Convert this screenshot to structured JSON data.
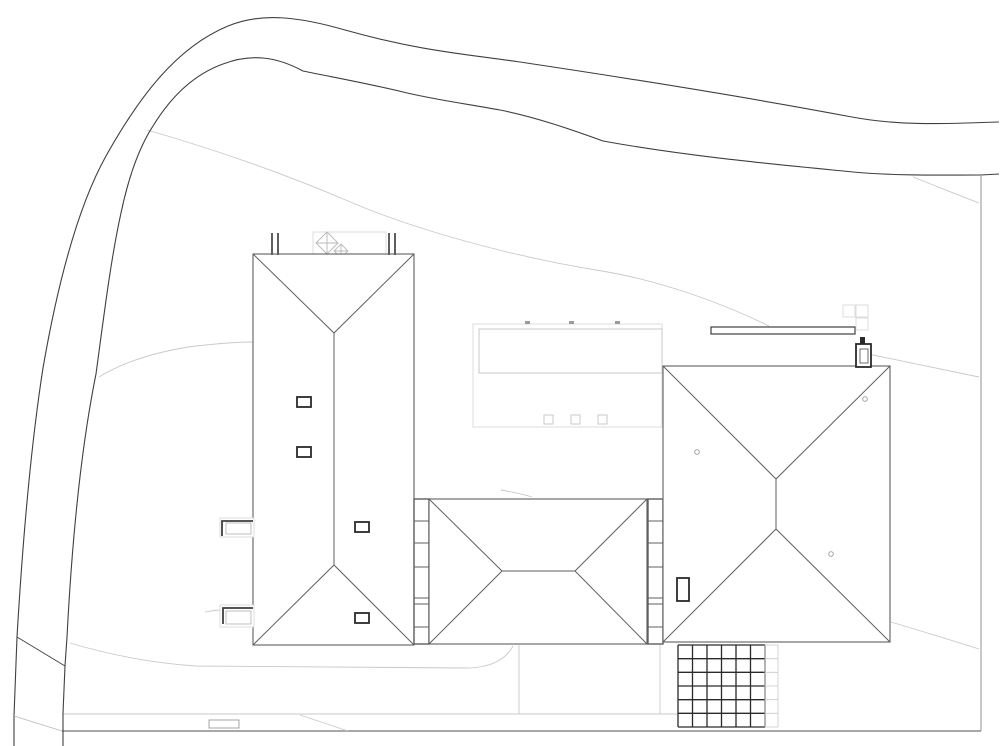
{
  "document": {
    "kind": "architectural-site-plan-roof-view",
    "visible_text": ""
  },
  "canvas": {
    "width": 1000,
    "height": 746,
    "background": "#ffffff"
  },
  "palette": {
    "road": "#3f3f3f",
    "roof": "#5f5f5f",
    "dark": "#2a2a2a",
    "mid": "#9b9b9b",
    "soft": "#b8b8b8",
    "light": "#c9c9c9",
    "faint": "#dcdcdc",
    "white": "#ffffff"
  },
  "layers": [
    {
      "name": "terrain-contours",
      "primitives": [
        {
          "type": "path",
          "name": "contour-upper",
          "d": "M 147,130 C 210,148 280,172 348,201 C 420,232 520,258 602,271 C 662,281 722,303 769,326",
          "stroke": "light",
          "sw": 0.9
        },
        {
          "type": "path",
          "name": "contour-left",
          "d": "M 99,377 C 125,361 158,352 188,347 C 212,344 235,342 253,342",
          "stroke": "light",
          "sw": 0.9
        },
        {
          "type": "path",
          "name": "contour-right-top",
          "d": "M 913,177 C 936,186 958,195 979,203",
          "stroke": "light",
          "sw": 0.9
        },
        {
          "type": "path",
          "name": "contour-right-mid",
          "d": "M 868,354 C 906,362 944,370 979,377",
          "stroke": "light",
          "sw": 0.9
        },
        {
          "type": "path",
          "name": "contour-right-bottom",
          "d": "M 891,622 C 921,631 951,640 979,649",
          "stroke": "light",
          "sw": 0.9
        },
        {
          "type": "path",
          "name": "contour-fragment-a",
          "d": "M 205,612 C 211,611 216,610 221,610",
          "stroke": "light",
          "sw": 0.9
        },
        {
          "type": "path",
          "name": "contour-fragment-b",
          "d": "M 388,620 C 398,622 407,624 414,628",
          "stroke": "light",
          "sw": 0.9
        },
        {
          "type": "path",
          "name": "contour-fragment-c",
          "d": "M 501,490 C 512,492 523,494 532,497",
          "stroke": "light",
          "sw": 0.9
        }
      ]
    },
    {
      "name": "paths-and-driveway",
      "primitives": [
        {
          "type": "path",
          "name": "driveway-edge",
          "d": "M 70,643 C 110,655 152,663 196,666 L 466,668 C 488,668 505,661 513,646",
          "stroke": "light",
          "sw": 0.9
        },
        {
          "type": "line",
          "name": "walk-upper-edge",
          "x1": 63,
          "y1": 714,
          "x2": 678,
          "y2": 714,
          "stroke": "light",
          "sw": 0.9
        },
        {
          "type": "line",
          "name": "walk-lower-edge",
          "x1": 62,
          "y1": 731,
          "x2": 981,
          "y2": 731,
          "stroke": "mid",
          "sw": 1.7
        },
        {
          "type": "line",
          "name": "walk-ramp-diagonal",
          "x1": 300,
          "y1": 715,
          "x2": 348,
          "y2": 731,
          "stroke": "light",
          "sw": 0.9
        },
        {
          "type": "line",
          "name": "court-divider-left",
          "x1": 519,
          "y1": 645,
          "x2": 519,
          "y2": 714,
          "stroke": "light",
          "sw": 0.9
        },
        {
          "type": "line",
          "name": "court-divider-right",
          "x1": 660,
          "y1": 645,
          "x2": 660,
          "y2": 714,
          "stroke": "light",
          "sw": 0.9
        },
        {
          "type": "rect",
          "name": "walk-inset-marker",
          "x": 209,
          "y": 720,
          "w": 30,
          "h": 8,
          "stroke": "mid",
          "sw": 0.9,
          "fill": "white"
        }
      ]
    },
    {
      "name": "road",
      "primitives": [
        {
          "type": "path",
          "name": "road-outer-edge",
          "d": "M 14,746 L 14,716 L 17,637 C 23,535 31,445 43,368 C 56,293 76,210 106,156 C 138,99 175,48 228,26 C 262,12 300,17 345,30 C 420,51 465,54 520,62 C 640,80 762,100 852,117 C 905,127 958,123 999,122",
          "stroke": "road",
          "sw": 1.1
        },
        {
          "type": "path",
          "name": "road-inner-edge",
          "d": "M 63,746 L 63,713 L 65,666 L 67,637 C 72,540 81,448 96,374 C 104,315 111,258 121,213 C 129,175 140,146 153,126 C 172,95 195,74 223,64 C 252,53 277,57 303,71 C 337,78 370,84 403,92 C 436,100 468,104 500,110 C 535,117 570,129 603,141 C 685,156 772,164 853,172 C 898,176 942,175 981,175 L 999,174",
          "stroke": "road",
          "sw": 1.1
        },
        {
          "type": "line",
          "name": "road-spur-upper",
          "x1": 17,
          "y1": 637,
          "x2": 65,
          "y2": 666,
          "stroke": "road",
          "sw": 0.9
        },
        {
          "type": "line",
          "name": "road-spur-lower",
          "x1": 14,
          "y1": 716,
          "x2": 62,
          "y2": 731,
          "stroke": "soft",
          "sw": 0.9
        },
        {
          "type": "line",
          "name": "property-boundary",
          "x1": 981,
          "y1": 175,
          "x2": 981,
          "y2": 731,
          "stroke": "mid",
          "sw": 1.1
        }
      ]
    },
    {
      "name": "flat-roof-court",
      "primitives": [
        {
          "type": "rect",
          "name": "flat-roof-outline",
          "x": 473,
          "y": 324,
          "w": 189,
          "h": 103,
          "stroke": "faint",
          "sw": 1,
          "fill": "white"
        },
        {
          "type": "rect",
          "name": "flat-roof-inner-panel",
          "x": 479,
          "y": 329,
          "w": 183,
          "h": 44,
          "stroke": "light",
          "sw": 1,
          "fill": "white"
        },
        {
          "type": "rect",
          "name": "court-skylight-1",
          "x": 544,
          "y": 415,
          "w": 9,
          "h": 9,
          "stroke": "light",
          "sw": 1,
          "fill": "white"
        },
        {
          "type": "rect",
          "name": "court-skylight-2",
          "x": 571,
          "y": 415,
          "w": 9,
          "h": 9,
          "stroke": "light",
          "sw": 1,
          "fill": "white"
        },
        {
          "type": "rect",
          "name": "court-skylight-3",
          "x": 598,
          "y": 415,
          "w": 9,
          "h": 9,
          "stroke": "light",
          "sw": 1,
          "fill": "white"
        },
        {
          "type": "rect",
          "name": "court-tick-1",
          "x": 525,
          "y": 321,
          "w": 5,
          "h": 3,
          "fill": "mid"
        },
        {
          "type": "rect",
          "name": "court-tick-2",
          "x": 569,
          "y": 321,
          "w": 5,
          "h": 3,
          "fill": "mid"
        },
        {
          "type": "rect",
          "name": "court-tick-3",
          "x": 615,
          "y": 321,
          "w": 5,
          "h": 3,
          "fill": "mid"
        }
      ]
    },
    {
      "name": "rear-terrace",
      "primitives": [
        {
          "type": "rect",
          "name": "terrace-outline",
          "x": 313,
          "y": 232,
          "w": 73,
          "h": 23,
          "stroke": "faint",
          "sw": 1,
          "fill": "white"
        },
        {
          "type": "path",
          "name": "terrace-pyramid-skylight-large",
          "d": "M 327,232 L 338,243 L 327,254 L 316,243 Z M 316,243 L 338,243 M 327,232 L 327,254",
          "stroke": "soft",
          "sw": 0.9
        },
        {
          "type": "path",
          "name": "terrace-pyramid-skylight-small",
          "d": "M 341,244 L 348,251 L 341,258 L 334,251 Z M 334,251 L 348,251 M 341,244 L 341,258",
          "stroke": "soft",
          "sw": 0.9
        }
      ]
    },
    {
      "name": "garden-wall",
      "primitives": [
        {
          "type": "rect",
          "name": "garden-wall-bar",
          "x": 711,
          "y": 327,
          "w": 144,
          "h": 7,
          "stroke": "road",
          "sw": 1.2,
          "fill": "white"
        },
        {
          "type": "rect",
          "name": "paving-square-1",
          "x": 843,
          "y": 305,
          "w": 12,
          "h": 12,
          "stroke": "faint",
          "sw": 1,
          "fill": "white"
        },
        {
          "type": "rect",
          "name": "paving-square-2",
          "x": 856,
          "y": 305,
          "w": 12,
          "h": 12,
          "stroke": "faint",
          "sw": 1,
          "fill": "white"
        },
        {
          "type": "rect",
          "name": "paving-square-3",
          "x": 856,
          "y": 318,
          "w": 12,
          "h": 12,
          "stroke": "faint",
          "sw": 1,
          "fill": "white"
        }
      ]
    },
    {
      "name": "building-a-west-wing",
      "primitives": [
        {
          "type": "rect",
          "name": "building-a-outline",
          "x": 253,
          "y": 254,
          "w": 161,
          "h": 391,
          "stroke": "roof",
          "sw": 1.1,
          "fill": "white"
        },
        {
          "type": "path",
          "name": "building-a-hip-lines",
          "d": "M 253,254 L 334,333 L 414,254 M 334,333 L 334,565 M 253,645 L 334,565 L 414,645",
          "stroke": "roof",
          "sw": 1
        },
        {
          "type": "rect",
          "name": "chimney-flue-a1",
          "x": 271,
          "y": 233,
          "w": 2,
          "h": 22,
          "fill": "roof"
        },
        {
          "type": "rect",
          "name": "chimney-flue-a2",
          "x": 277,
          "y": 233,
          "w": 2,
          "h": 22,
          "fill": "roof"
        },
        {
          "type": "rect",
          "name": "chimney-flue-a3",
          "x": 388,
          "y": 233,
          "w": 2,
          "h": 22,
          "fill": "roof"
        },
        {
          "type": "rect",
          "name": "chimney-flue-a4",
          "x": 394,
          "y": 233,
          "w": 2,
          "h": 22,
          "fill": "roof"
        },
        {
          "type": "rect",
          "name": "roof-window-a1",
          "x": 297,
          "y": 397,
          "w": 14,
          "h": 10,
          "stroke": "dark",
          "sw": 1.8,
          "fill": "white"
        },
        {
          "type": "rect",
          "name": "roof-window-a2",
          "x": 297,
          "y": 447,
          "w": 14,
          "h": 10,
          "stroke": "dark",
          "sw": 1.8,
          "fill": "white"
        },
        {
          "type": "rect",
          "name": "roof-window-a3",
          "x": 355,
          "y": 522,
          "w": 14,
          "h": 10,
          "stroke": "dark",
          "sw": 1.8,
          "fill": "white"
        },
        {
          "type": "rect",
          "name": "roof-window-a4",
          "x": 355,
          "y": 613,
          "w": 14,
          "h": 10,
          "stroke": "dark",
          "sw": 1.8,
          "fill": "white"
        }
      ]
    },
    {
      "name": "building-b-link-wing",
      "primitives": [
        {
          "type": "rect",
          "name": "glazing-strip-west",
          "x": 414,
          "y": 499,
          "w": 15,
          "h": 145,
          "stroke": "roof",
          "sw": 1.4,
          "fill": "white"
        },
        {
          "type": "path",
          "name": "glazing-strip-west-dividers",
          "d": "M 414,521 L 429,521 M 414,543 L 429,543 M 414,567 L 429,567 M 414,598 L 429,598 M 414,604 L 429,604 M 414,627 L 429,627",
          "stroke": "roof",
          "sw": 1
        },
        {
          "type": "rect",
          "name": "glazing-strip-east",
          "x": 648,
          "y": 499,
          "w": 15,
          "h": 145,
          "stroke": "roof",
          "sw": 1.4,
          "fill": "white"
        },
        {
          "type": "path",
          "name": "glazing-strip-east-dividers",
          "d": "M 648,521 L 663,521 M 648,543 L 663,543 M 648,567 L 663,567 M 648,598 L 663,598 M 648,604 L 663,604 M 648,627 L 663,627",
          "stroke": "roof",
          "sw": 1
        },
        {
          "type": "rect",
          "name": "building-b-outline",
          "x": 429,
          "y": 499,
          "w": 218,
          "h": 145,
          "stroke": "roof",
          "sw": 1.1,
          "fill": "white"
        },
        {
          "type": "path",
          "name": "building-b-hip-lines",
          "d": "M 429,499 L 502,571 L 429,644 M 502,571 L 575,571 M 647,499 L 575,571 L 647,644",
          "stroke": "roof",
          "sw": 1
        }
      ]
    },
    {
      "name": "building-c-east-wing",
      "primitives": [
        {
          "type": "rect",
          "name": "building-c-outline",
          "x": 663,
          "y": 366,
          "w": 227,
          "h": 276,
          "stroke": "roof",
          "sw": 1.1,
          "fill": "white"
        },
        {
          "type": "path",
          "name": "building-c-hip-lines",
          "d": "M 663,366 L 776,479 L 890,366 M 776,479 L 776,529 M 663,642 L 776,529 L 890,642",
          "stroke": "roof",
          "sw": 1
        },
        {
          "type": "circle",
          "name": "roof-vent-c1",
          "cx": 697,
          "cy": 452,
          "r": 2.3,
          "stroke": "mid",
          "sw": 0.9,
          "fill": "white"
        },
        {
          "type": "circle",
          "name": "roof-vent-c2",
          "cx": 865,
          "cy": 399,
          "r": 2.3,
          "stroke": "mid",
          "sw": 0.9,
          "fill": "white"
        },
        {
          "type": "circle",
          "name": "roof-vent-c3",
          "cx": 831,
          "cy": 554,
          "r": 2.3,
          "stroke": "mid",
          "sw": 0.9,
          "fill": "white"
        },
        {
          "type": "rect",
          "name": "chimney-c",
          "x": 677,
          "y": 578,
          "w": 12,
          "h": 23,
          "stroke": "dark",
          "sw": 1.8,
          "fill": "white"
        },
        {
          "type": "rect",
          "name": "flue-box",
          "x": 856,
          "y": 344,
          "w": 15,
          "h": 23,
          "stroke": "dark",
          "sw": 1.8,
          "fill": "white"
        },
        {
          "type": "rect",
          "name": "flue-box-inner",
          "x": 860,
          "y": 349,
          "w": 8,
          "h": 14,
          "stroke": "roof",
          "sw": 0.9,
          "fill": "none"
        },
        {
          "type": "rect",
          "name": "flue-cap",
          "x": 860,
          "y": 337,
          "w": 5,
          "h": 7,
          "fill": "dark"
        }
      ]
    },
    {
      "name": "pergola",
      "primitives": [
        {
          "type": "grid",
          "name": "pergola-grid",
          "x": 678,
          "y": 645,
          "w": 87,
          "h": 82,
          "cols": 6,
          "rows": 6,
          "stroke": "dark",
          "sw": 1.3
        },
        {
          "type": "grid",
          "name": "pergola-extension",
          "x": 765,
          "y": 645,
          "w": 13,
          "h": 82,
          "cols": 1,
          "rows": 6,
          "stroke": "light",
          "sw": 0.8
        }
      ]
    },
    {
      "name": "light-wells",
      "primitives": [
        {
          "type": "rect",
          "name": "light-well-upper-outline",
          "x": 220,
          "y": 518,
          "w": 34,
          "h": 19,
          "stroke": "faint",
          "sw": 1,
          "fill": "white"
        },
        {
          "type": "rect",
          "name": "light-well-upper-inner",
          "x": 226,
          "y": 523,
          "w": 25,
          "h": 11,
          "stroke": "soft",
          "sw": 0.9,
          "fill": "none"
        },
        {
          "type": "path",
          "name": "light-well-upper-wall",
          "d": "M 222,536 L 222,521 L 253,521",
          "stroke": "road",
          "sw": 1.8
        },
        {
          "type": "rect",
          "name": "light-well-lower-outline",
          "x": 220,
          "y": 605,
          "w": 34,
          "h": 22,
          "stroke": "faint",
          "sw": 1,
          "fill": "white"
        },
        {
          "type": "rect",
          "name": "light-well-lower-inner",
          "x": 226,
          "y": 611,
          "w": 25,
          "h": 13,
          "stroke": "soft",
          "sw": 0.9,
          "fill": "none"
        },
        {
          "type": "path",
          "name": "light-well-lower-wall",
          "d": "M 223,624 L 223,608 L 253,608",
          "stroke": "road",
          "sw": 1.8
        }
      ]
    }
  ]
}
